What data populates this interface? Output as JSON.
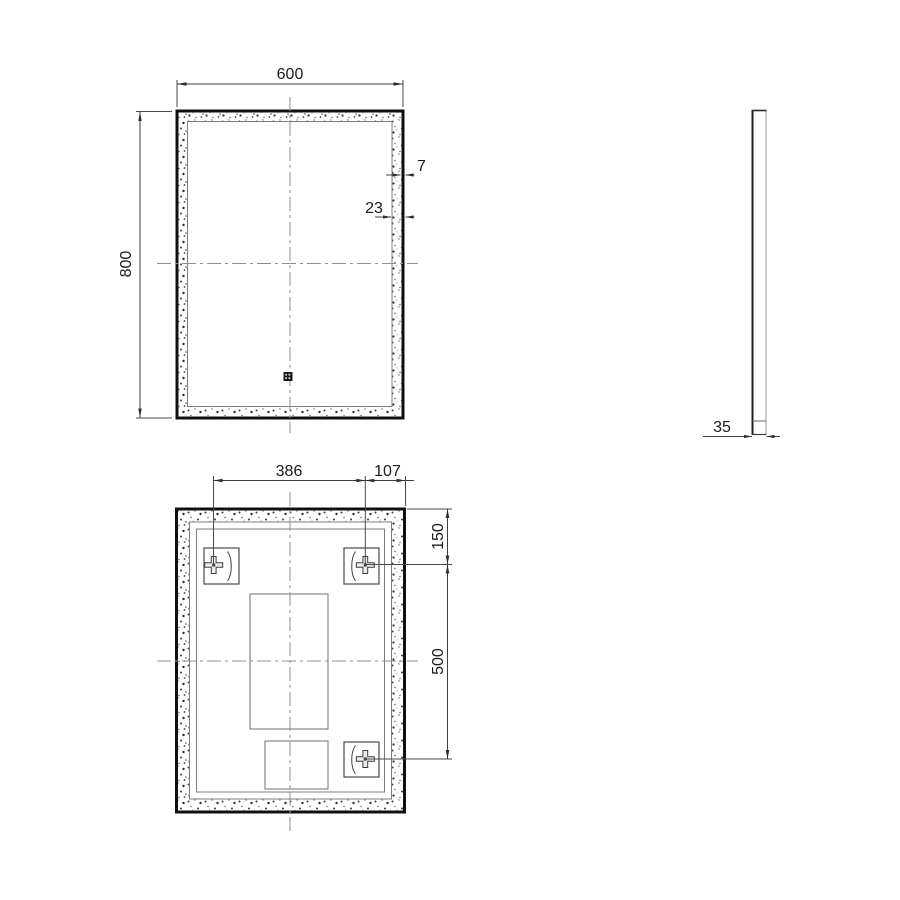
{
  "drawing": {
    "title": "mirror-three-view-dimension-drawing",
    "views": {
      "front": {
        "dim_width": "600",
        "dim_height": "800",
        "dim_frame": "7",
        "dim_band": "23"
      },
      "side": {
        "dim_depth": "35"
      },
      "back": {
        "dim_bracket_span": "386",
        "dim_bracket_offset": "107",
        "dim_bracket_top": "150",
        "dim_bracket_vspan": "500"
      }
    },
    "colors": {
      "background": "#ffffff",
      "frame_line": "#101010",
      "thin_line": "#3f3f3f",
      "inner_line": "#7d7d7d",
      "centerline": "#8f8f8f",
      "text": "#1b1b1b"
    }
  }
}
